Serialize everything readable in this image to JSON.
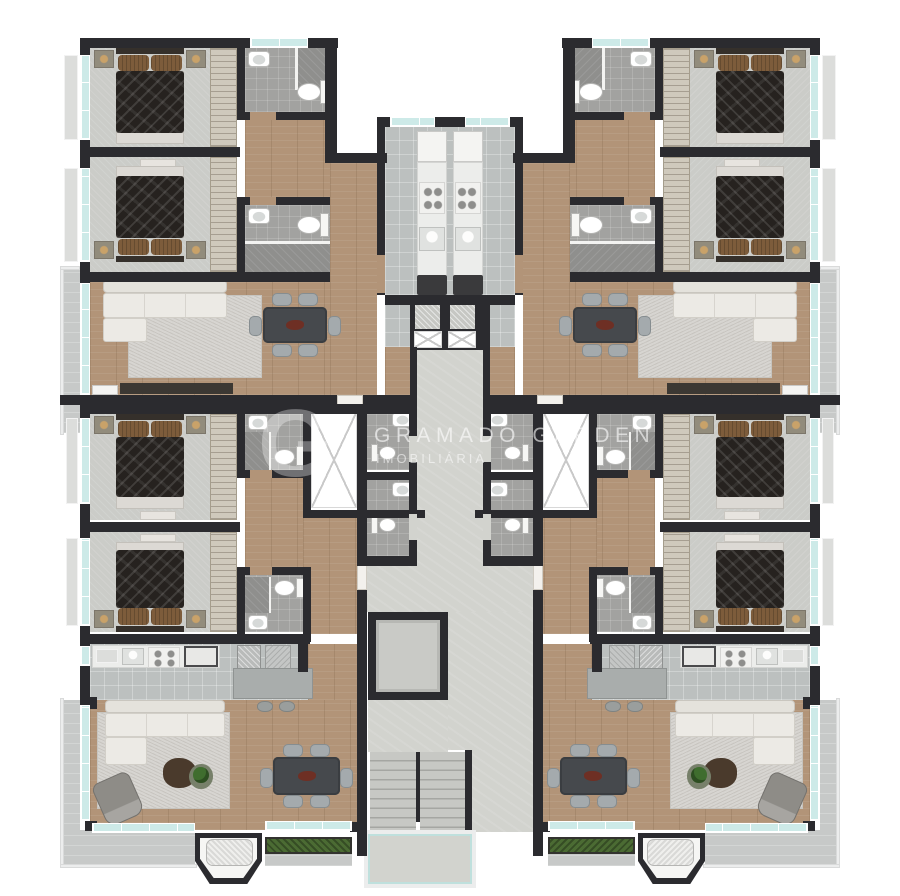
{
  "watermark": {
    "brand": "GRAMADO GARDEN",
    "tagline": "IMOBILIÁRIA",
    "logo_glyph": "G"
  },
  "palette": {
    "wall": "#2b2b2f",
    "wood_floor": "#b29478",
    "bedroom_carpet": "#cbccc8",
    "kitchen_tile": "#bcc0bf",
    "bathroom_floor": "#a2a2a0",
    "shower_floor": "#8f8f8d",
    "corridor_concrete": "#d2d3ce",
    "balcony_floor": "#c7c9c8",
    "window_glass": "#cdeae8",
    "window_frame": "#ffffff",
    "sofa": "#eceae5",
    "rug": "#d7d5d1",
    "dining_table": "#46494d",
    "chair": "#a4aaad",
    "bed_duvet": "#26221f",
    "pillow": "#7d5c3b",
    "counter": "#ecedeb",
    "plant": "#3f6d2e",
    "planter_hedge": "#4b6b33",
    "appliance_dark": "#3a3a3c",
    "exterior": "#ffffff"
  },
  "floor_plan": {
    "type": "residential-apartment-building-typical-floor",
    "units_count": 4,
    "unit_layout_rooms": [
      "bedroom-1",
      "bedroom-2",
      "bathroom-1",
      "bathroom-2",
      "kitchen",
      "living-dining-room",
      "balcony"
    ],
    "core_elements": [
      "elevator-shaft-pair",
      "ventilation-shaft",
      "central-corridor",
      "entry-hall",
      "service-bathrooms",
      "elevator",
      "staircase",
      "stair-landing"
    ],
    "furniture_items": [
      "double-bed",
      "nightstand-with-lamp",
      "wardrobe",
      "ottoman-bench",
      "toilet",
      "washbasin",
      "shower",
      "refrigerator",
      "cooktop",
      "kitchen-sink",
      "oven",
      "sofa-l-shaped",
      "rug",
      "armchair",
      "coffee-table",
      "potted-plant",
      "dining-table",
      "dining-chair",
      "sideboard",
      "kitchen-peninsula",
      "bar-stool",
      "barbecue-grill-bay",
      "planter-hedge"
    ]
  }
}
